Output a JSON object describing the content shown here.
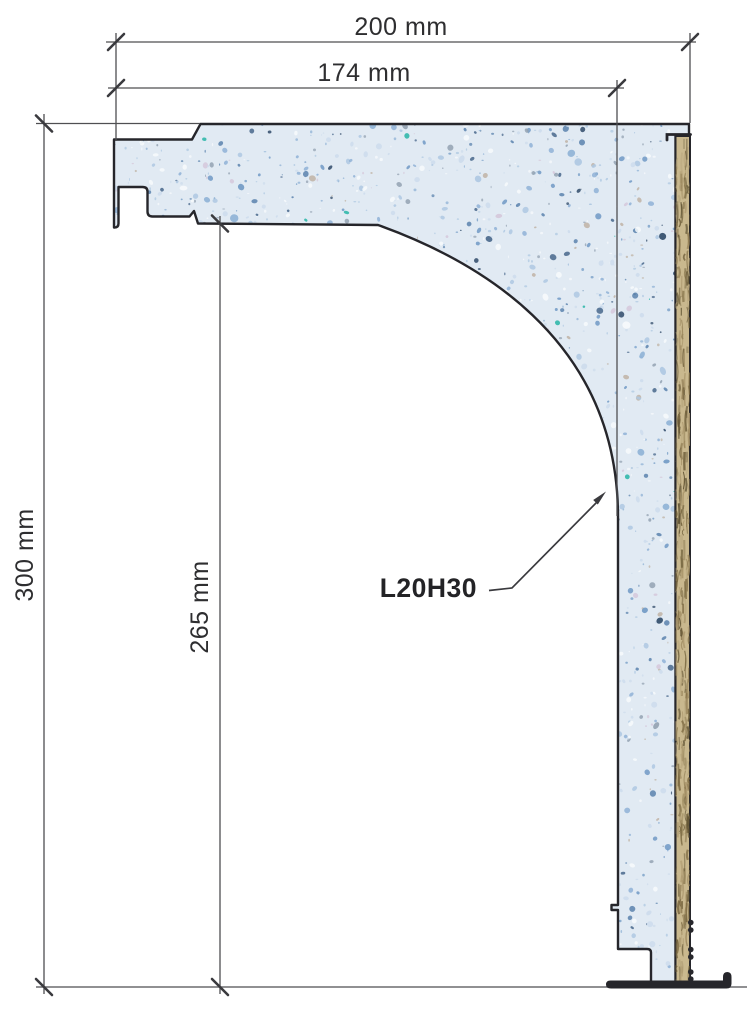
{
  "drawing": {
    "labels": {
      "dim_width_outer": "200 mm",
      "dim_width_inner": "174 mm",
      "dim_height_outer": "300 mm",
      "dim_height_inner": "265 mm",
      "product_code": "L20H30"
    },
    "colors": {
      "background": "#ffffff",
      "outline": "#26262b",
      "dim_line": "#4f4f52",
      "tick": "#3a3a3e",
      "label_text": "#2e2e30",
      "product_text": "#232326",
      "foam_base": "#e1eaf3",
      "wood_base": "#c9b88e",
      "floor_line": "#6b6b6e"
    },
    "speckle_palette": [
      {
        "c": "#f7fafc",
        "w": 18
      },
      {
        "c": "#cddcec",
        "w": 16
      },
      {
        "c": "#aec8e2",
        "w": 14
      },
      {
        "c": "#8fb2d6",
        "w": 12
      },
      {
        "c": "#7099c4",
        "w": 8
      },
      {
        "c": "#5b83ad",
        "w": 6
      },
      {
        "c": "#48678b",
        "w": 4
      },
      {
        "c": "#93a2b1",
        "w": 6
      },
      {
        "c": "#2f4a68",
        "w": 3
      },
      {
        "c": "#27b5a6",
        "w": 1.5
      },
      {
        "c": "#d5c8da",
        "w": 4
      },
      {
        "c": "#bfb3a4",
        "w": 4
      }
    ],
    "wood_grain_palette": [
      "#9a865c",
      "#7d6a42",
      "#b5a37a",
      "#5f5233",
      "#a8946a",
      "#6e5e3a"
    ]
  }
}
